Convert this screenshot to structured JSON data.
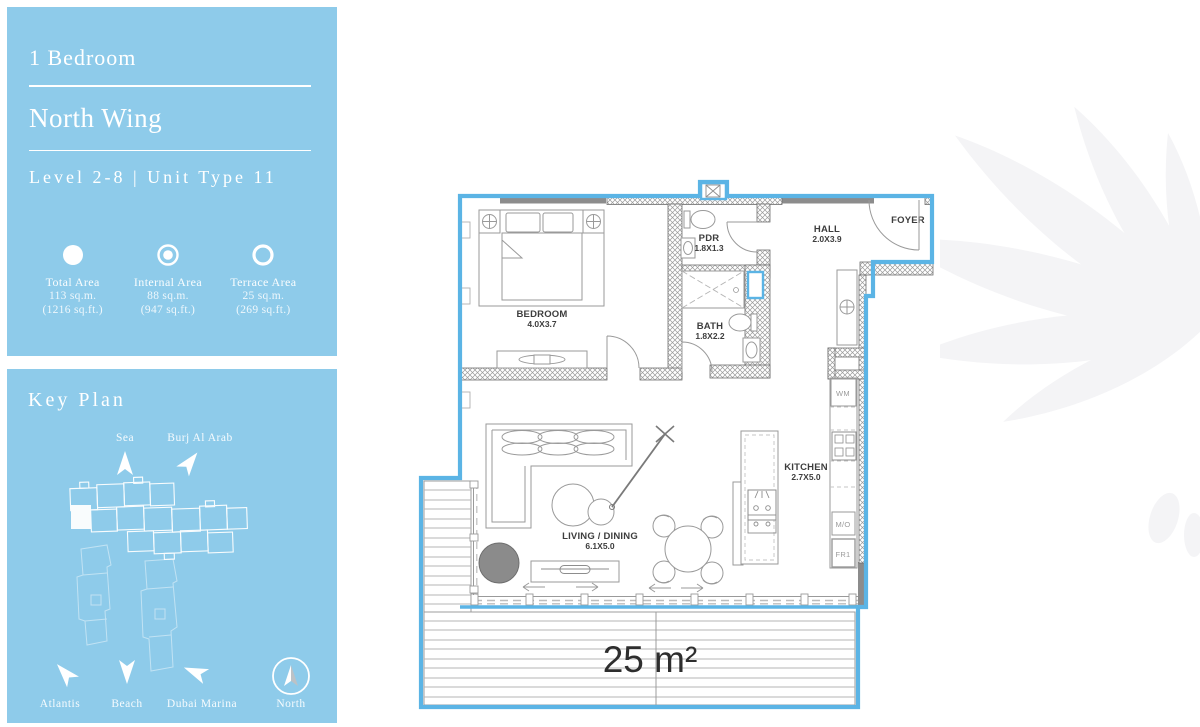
{
  "panel": {
    "bedrooms": "1 Bedroom",
    "wing": "North Wing",
    "level_unit": "Level 2-8 | Unit Type 11",
    "stats": [
      {
        "icon": "filled-circle",
        "label": "Total Area",
        "sqm": "113 sq.m.",
        "sqft": "(1216 sq.ft.)"
      },
      {
        "icon": "ring-dot-circle",
        "label": "Internal Area",
        "sqm": "88 sq.m.",
        "sqft": "(947 sq.ft.)"
      },
      {
        "icon": "ring-circle",
        "label": "Terrace Area",
        "sqm": "25 sq.m.",
        "sqft": "(269 sq.ft.)"
      }
    ]
  },
  "key_plan": {
    "title": "Key Plan",
    "directions": [
      {
        "label": "Sea"
      },
      {
        "label": "Burj Al Arab"
      },
      {
        "label": "Atlantis"
      },
      {
        "label": "Beach"
      },
      {
        "label": "Dubai Marina"
      }
    ],
    "compass_label": "North"
  },
  "floor_plan": {
    "rooms": [
      {
        "name": "BEDROOM",
        "dims": "4.0X3.7"
      },
      {
        "name": "PDR",
        "dims": "1.8X1.3"
      },
      {
        "name": "HALL",
        "dims": "2.0X3.9"
      },
      {
        "name": "FOYER",
        "dims": ""
      },
      {
        "name": "BATH",
        "dims": "1.8X2.2"
      },
      {
        "name": "KITCHEN",
        "dims": "2.7X5.0"
      },
      {
        "name": "LIVING / DINING",
        "dims": "6.1X5.0"
      }
    ],
    "appliances": [
      "WM",
      "M/O",
      "FR1"
    ],
    "terrace_area_label": "25 m²",
    "colors": {
      "panel_blue": "#8ECBEA",
      "plan_outline_blue": "#5BB4E5",
      "window_track_gray": "#8C8C8C",
      "furniture_gray": "#9A9A9A",
      "label_dark": "#3D3D3D",
      "watermark": "#F4F4F6"
    }
  }
}
